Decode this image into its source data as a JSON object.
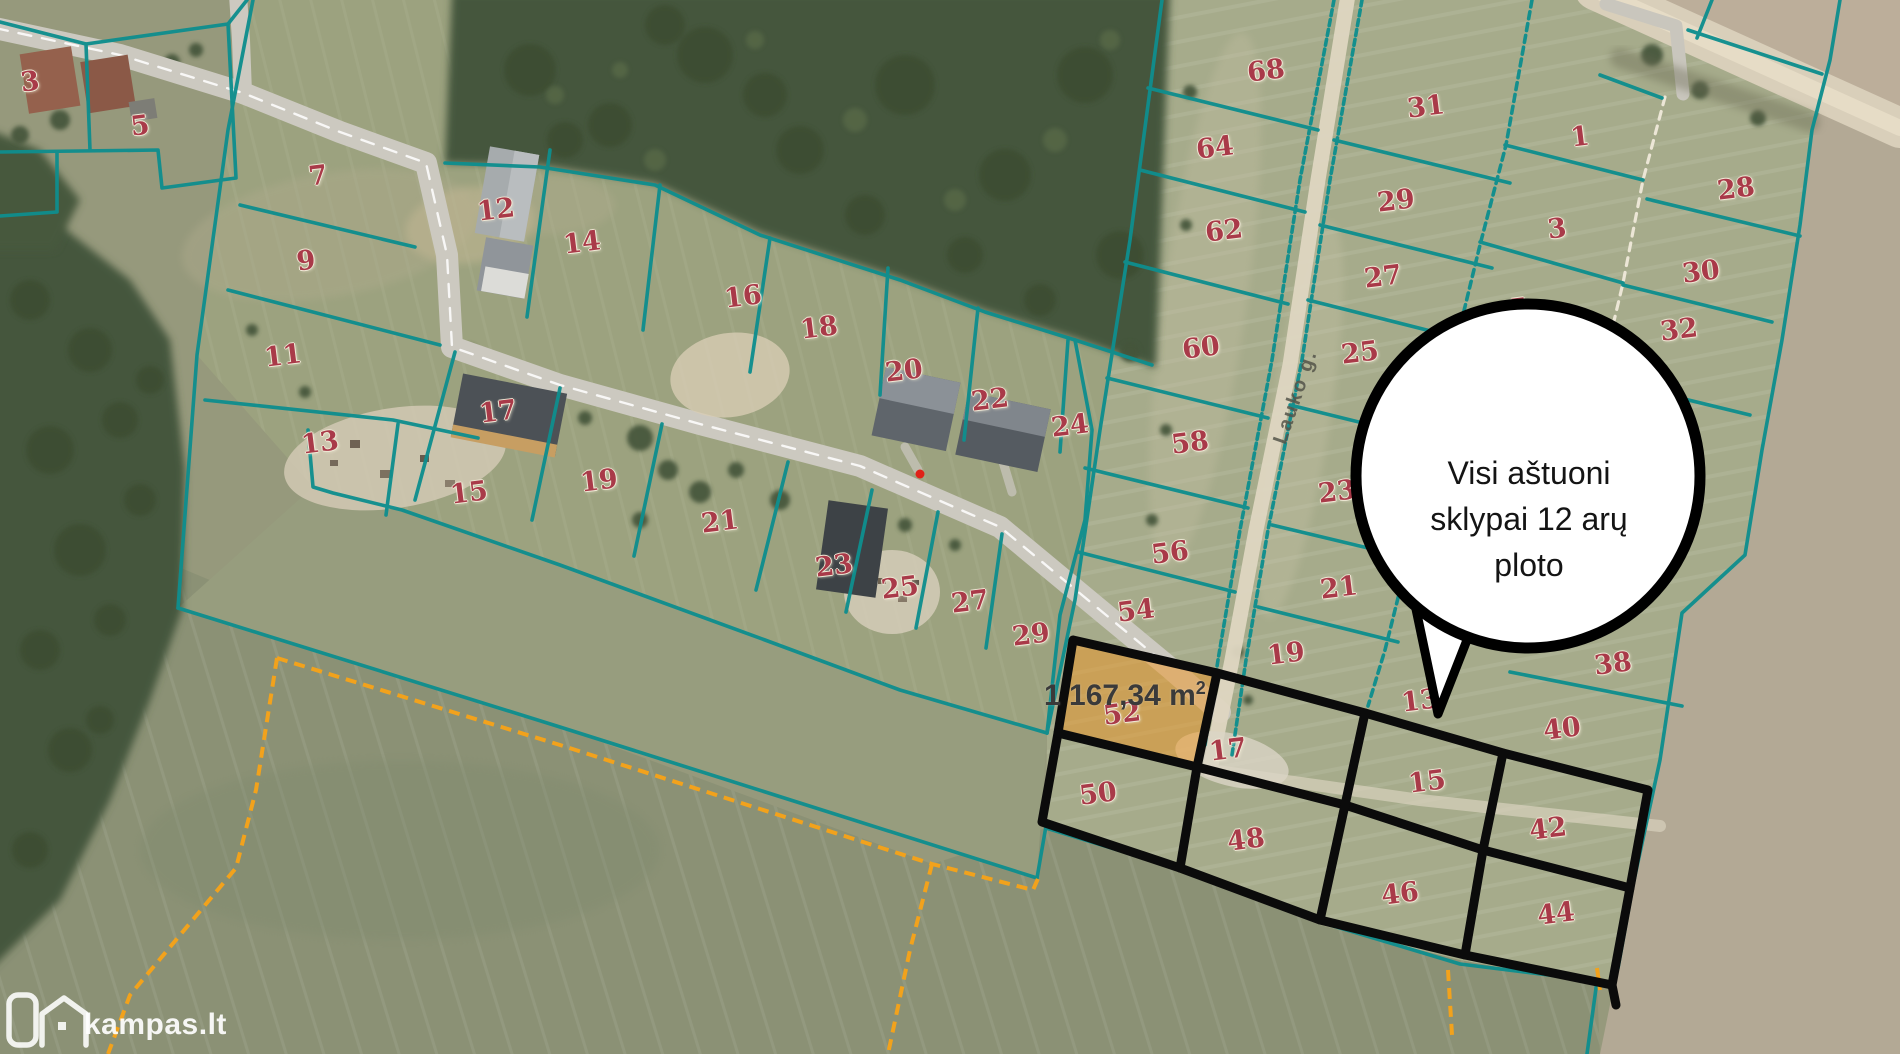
{
  "map": {
    "attribution": "kampas.lt",
    "street_label": "Lauko g.",
    "bubble": {
      "line1": "Visi aštuoni",
      "line2": "sklypai 12 arų",
      "line3": "ploto"
    },
    "highlight": {
      "area_text": "1 167,34 m",
      "area_sup": "2"
    },
    "colors": {
      "parcel_line": "#0f8e8e",
      "sale_outline": "#0b0b0b",
      "highlight_fill": "#ed9623",
      "highlight_border": "#f59b20",
      "boundary_dashed_line": "#f2a21c",
      "plot_number_red": "#a93a49"
    },
    "plot_numbers": [
      {
        "label": "3",
        "x": 30,
        "y": 82
      },
      {
        "label": "5",
        "x": 140,
        "y": 126
      },
      {
        "label": "7",
        "x": 318,
        "y": 176
      },
      {
        "label": "9",
        "x": 306,
        "y": 261
      },
      {
        "label": "11",
        "x": 283,
        "y": 356
      },
      {
        "label": "13",
        "x": 320,
        "y": 443
      },
      {
        "label": "15",
        "x": 469,
        "y": 493
      },
      {
        "label": "12",
        "x": 496,
        "y": 210
      },
      {
        "label": "14",
        "x": 582,
        "y": 243
      },
      {
        "label": "16",
        "x": 743,
        "y": 297
      },
      {
        "label": "18",
        "x": 819,
        "y": 328
      },
      {
        "label": "20",
        "x": 904,
        "y": 371
      },
      {
        "label": "22",
        "x": 990,
        "y": 400
      },
      {
        "label": "24",
        "x": 1070,
        "y": 426
      },
      {
        "label": "17",
        "x": 498,
        "y": 412
      },
      {
        "label": "19",
        "x": 599,
        "y": 481
      },
      {
        "label": "21",
        "x": 720,
        "y": 522
      },
      {
        "label": "23",
        "x": 834,
        "y": 566
      },
      {
        "label": "25",
        "x": 900,
        "y": 588
      },
      {
        "label": "27",
        "x": 970,
        "y": 602
      },
      {
        "label": "29",
        "x": 1031,
        "y": 635
      },
      {
        "label": "68",
        "x": 1266,
        "y": 71
      },
      {
        "label": "64",
        "x": 1215,
        "y": 148
      },
      {
        "label": "62",
        "x": 1224,
        "y": 231
      },
      {
        "label": "60",
        "x": 1201,
        "y": 348
      },
      {
        "label": "58",
        "x": 1190,
        "y": 443
      },
      {
        "label": "56",
        "x": 1170,
        "y": 553
      },
      {
        "label": "54",
        "x": 1136,
        "y": 611
      },
      {
        "label": "52",
        "x": 1122,
        "y": 714
      },
      {
        "label": "50",
        "x": 1098,
        "y": 794
      },
      {
        "label": "31",
        "x": 1426,
        "y": 107
      },
      {
        "label": "29",
        "x": 1396,
        "y": 201
      },
      {
        "label": "27",
        "x": 1383,
        "y": 277
      },
      {
        "label": "25",
        "x": 1360,
        "y": 353
      },
      {
        "label": "23",
        "x": 1337,
        "y": 492
      },
      {
        "label": "21",
        "x": 1339,
        "y": 588
      },
      {
        "label": "19",
        "x": 1286,
        "y": 654
      },
      {
        "label": "17",
        "x": 1228,
        "y": 750
      },
      {
        "label": "15",
        "x": 1427,
        "y": 782
      },
      {
        "label": "13",
        "x": 1420,
        "y": 701
      },
      {
        "label": "1",
        "x": 1580,
        "y": 137
      },
      {
        "label": "3",
        "x": 1557,
        "y": 229
      },
      {
        "label": "5",
        "x": 1519,
        "y": 309
      },
      {
        "label": "28",
        "x": 1736,
        "y": 189
      },
      {
        "label": "30",
        "x": 1701,
        "y": 272
      },
      {
        "label": "32",
        "x": 1679,
        "y": 330
      },
      {
        "label": "38",
        "x": 1613,
        "y": 664
      },
      {
        "label": "40",
        "x": 1562,
        "y": 729
      },
      {
        "label": "42",
        "x": 1548,
        "y": 829
      },
      {
        "label": "44",
        "x": 1556,
        "y": 914
      },
      {
        "label": "46",
        "x": 1400,
        "y": 894
      },
      {
        "label": "48",
        "x": 1246,
        "y": 840
      }
    ]
  }
}
